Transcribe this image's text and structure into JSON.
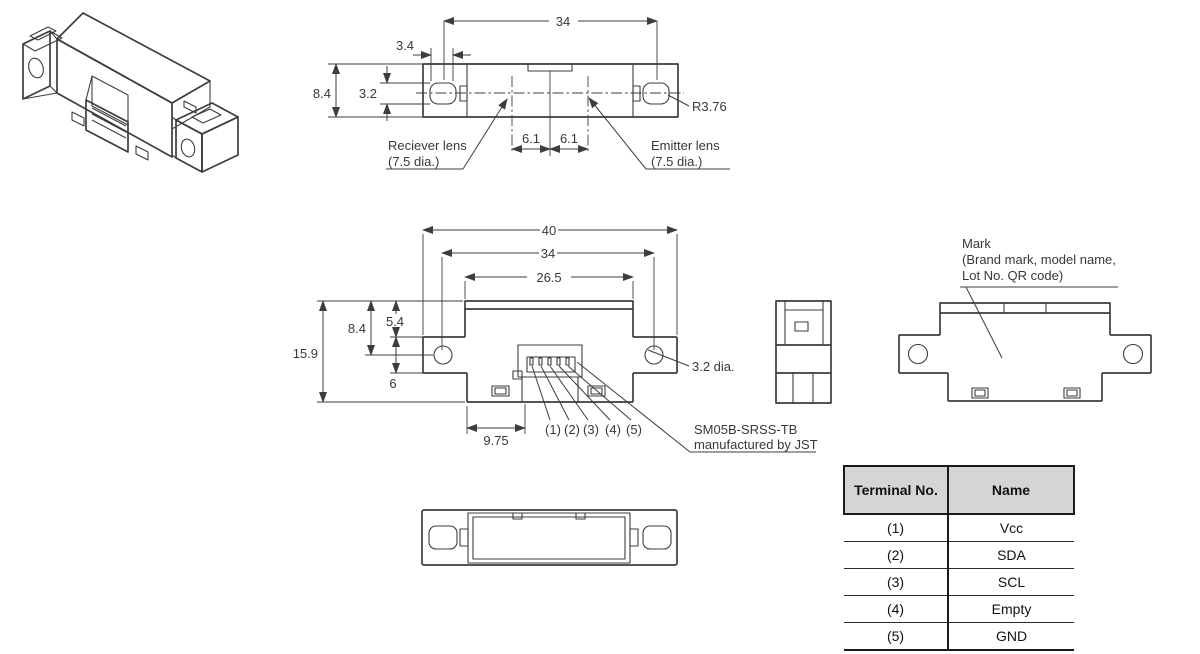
{
  "colors": {
    "line": "#3d3d3d",
    "text": "#383838",
    "table_header_bg": "#d5d5d5",
    "table_border": "#1a1a1a"
  },
  "views": {
    "top": {
      "dims": {
        "lens_pitch_34": "34",
        "lens_width_3_4": "3.4",
        "body_height_8_4": "8.4",
        "lens_height_3_2": "3.2",
        "offset_left_6_1": "6.1",
        "offset_right_6_1": "6.1",
        "corner_radius": "R3.76"
      },
      "labels": {
        "receiver_line1": "Reciever lens",
        "receiver_line2": "(7.5 dia.)",
        "emitter_line1": "Emitter lens",
        "emitter_line2": "(7.5 dia.)"
      }
    },
    "front": {
      "dims": {
        "overall_width_40": "40",
        "hole_pitch_34": "34",
        "body_width_26_5": "26.5",
        "top_to_hole_8_4": "8.4",
        "top_to_ear_5_4": "5.4",
        "overall_height_15_9": "15.9",
        "ear_height_6": "6",
        "connector_offset_9_75": "9.75",
        "hole_dia": "3.2 dia."
      },
      "pins": [
        "(1)",
        "(2)",
        "(3)",
        "(4)",
        "(5)"
      ],
      "connector_note": {
        "line1": "SM05B-SRSS-TB",
        "line2": "manufactured by JST"
      }
    },
    "rear": {
      "mark_note": {
        "line1": "Mark",
        "line2": "(Brand mark, model name,",
        "line3": "Lot No. QR code)"
      }
    }
  },
  "terminal_table": {
    "col_terminal": "Terminal No.",
    "col_name": "Name",
    "rows": [
      {
        "no": "(1)",
        "name": "Vcc"
      },
      {
        "no": "(2)",
        "name": "SDA"
      },
      {
        "no": "(3)",
        "name": "SCL"
      },
      {
        "no": "(4)",
        "name": "Empty"
      },
      {
        "no": "(5)",
        "name": "GND"
      }
    ]
  }
}
